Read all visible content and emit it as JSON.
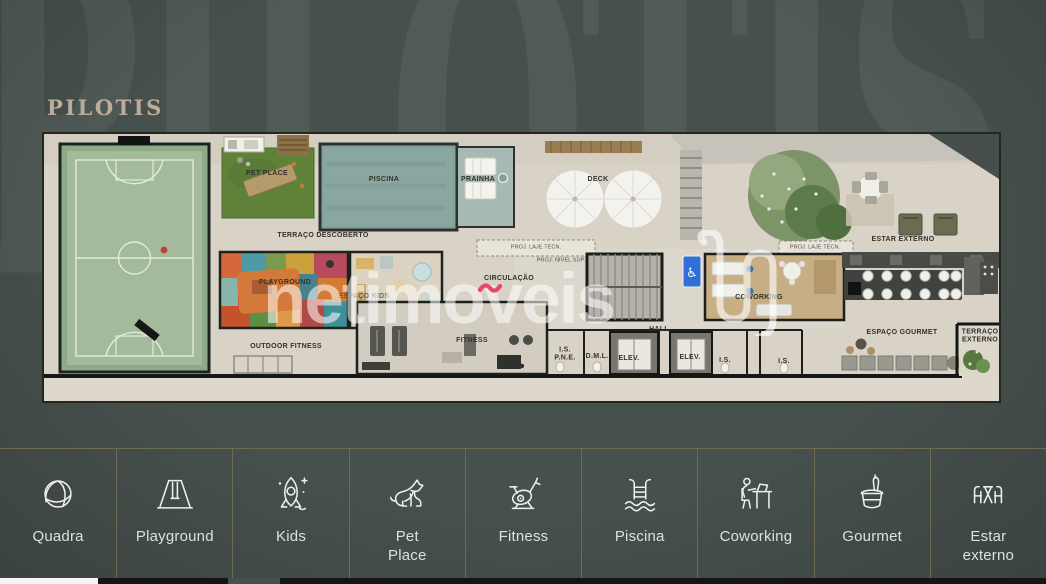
{
  "title": "PILOTIS",
  "background_word": "PILOTIS",
  "watermark": {
    "brand": "netimoveis",
    "accent_color": "#e8456f"
  },
  "colors": {
    "background": "#46504d",
    "title": "#bdab9c",
    "bar_separator": "#6e6b54",
    "accessibility_blue": "#2f6fd6"
  },
  "plan_labels": [
    {
      "id": "pet-place",
      "text": "PET PLACE",
      "x": 223,
      "y": 40
    },
    {
      "id": "piscina",
      "text": "PISCINA",
      "x": 340,
      "y": 46
    },
    {
      "id": "prainha",
      "text": "PRAINHA",
      "x": 434,
      "y": 46
    },
    {
      "id": "deck",
      "text": "DECK",
      "x": 554,
      "y": 46
    },
    {
      "id": "terraco-descoberto",
      "text": "TERRAÇO DESCOBERTO",
      "x": 279,
      "y": 102
    },
    {
      "id": "estar-externo",
      "text": "ESTAR EXTERNO",
      "x": 859,
      "y": 106
    },
    {
      "id": "proj-laje-tecn-1",
      "text": "PROJ. LAJE TÉCN.",
      "x": 492,
      "y": 114,
      "variant": "tiny"
    },
    {
      "id": "proj-nivel-sup",
      "text": "PROJ. NÍVEL SUP.",
      "x": 517,
      "y": 127,
      "variant": "tiny"
    },
    {
      "id": "proj-laje-tecn-2",
      "text": "PROJ. LAJE TÉCN.",
      "x": 771,
      "y": 114,
      "variant": "tiny"
    },
    {
      "id": "playground",
      "text": "PLAYGROUND",
      "x": 241,
      "y": 149
    },
    {
      "id": "espaco-kids",
      "text": "ESPAÇO KIDS",
      "x": 320,
      "y": 163,
      "variant": "faint"
    },
    {
      "id": "circulacao",
      "text": "CIRCULAÇÃO",
      "x": 465,
      "y": 145
    },
    {
      "id": "coworking",
      "text": "COWORKING",
      "x": 715,
      "y": 164
    },
    {
      "id": "outdoor-fitness",
      "text": "OUTDOOR FITNESS",
      "x": 242,
      "y": 213
    },
    {
      "id": "fitness",
      "text": "FITNESS",
      "x": 428,
      "y": 207
    },
    {
      "id": "hall",
      "text": "HALL",
      "x": 615,
      "y": 196
    },
    {
      "id": "is-pne",
      "text": "I.S.\nP.N.E.",
      "x": 521,
      "y": 221
    },
    {
      "id": "dml",
      "text": "D.M.L.",
      "x": 553,
      "y": 223
    },
    {
      "id": "elev-1",
      "text": "ELEV.",
      "x": 585,
      "y": 225
    },
    {
      "id": "elev-2",
      "text": "ELEV.",
      "x": 646,
      "y": 224
    },
    {
      "id": "is-1",
      "text": "I.S.",
      "x": 681,
      "y": 227
    },
    {
      "id": "is-2",
      "text": "I.S.",
      "x": 740,
      "y": 228
    },
    {
      "id": "espaco-gourmet",
      "text": "ESPAÇO GOURMET",
      "x": 858,
      "y": 199
    },
    {
      "id": "terraco-externo",
      "text": "TERRAÇO\nEXTERNO",
      "x": 936,
      "y": 203
    }
  ],
  "amenities": [
    {
      "id": "quadra",
      "label": "Quadra",
      "icon": "volleyball-icon"
    },
    {
      "id": "playground",
      "label": "Playground",
      "icon": "swing-icon"
    },
    {
      "id": "kids",
      "label": "Kids",
      "icon": "rocket-icon"
    },
    {
      "id": "pet-place",
      "label": "Pet\nPlace",
      "icon": "dog-icon"
    },
    {
      "id": "fitness",
      "label": "Fitness",
      "icon": "exercise-bike-icon"
    },
    {
      "id": "piscina",
      "label": "Piscina",
      "icon": "pool-ladder-icon"
    },
    {
      "id": "coworking",
      "label": "Coworking",
      "icon": "person-desk-icon"
    },
    {
      "id": "gourmet",
      "label": "Gourmet",
      "icon": "champagne-bucket-icon"
    },
    {
      "id": "estar-externo",
      "label": "Estar\nexterno",
      "icon": "outdoor-table-icon"
    }
  ]
}
